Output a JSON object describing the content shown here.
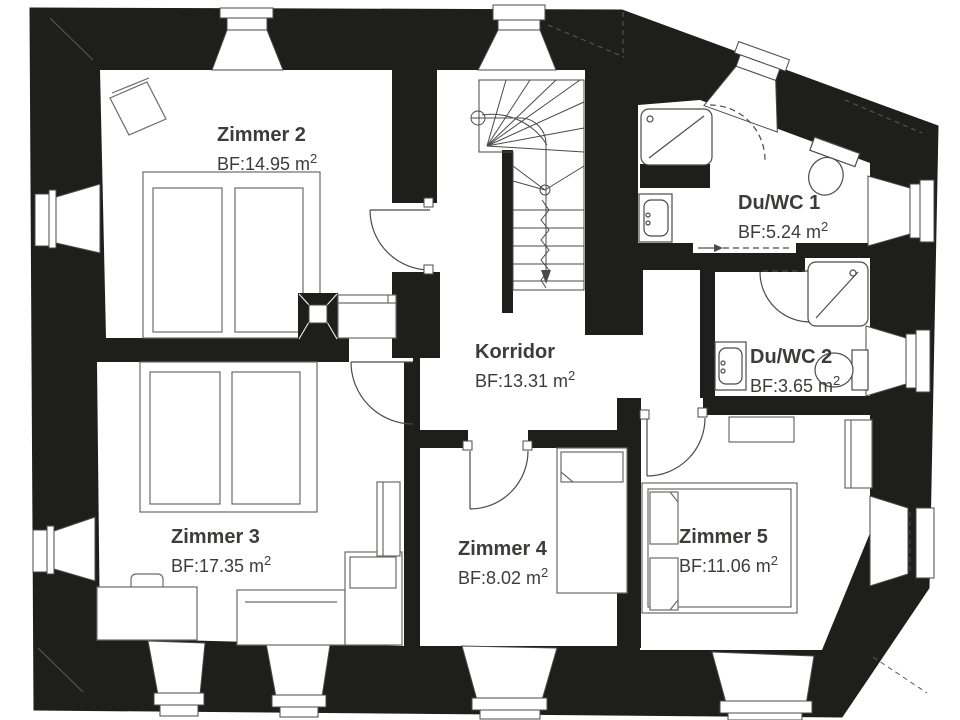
{
  "rooms": [
    {
      "name": "Zimmer 2",
      "bf": "BF:14.95 m",
      "sup": "2"
    },
    {
      "name": "Du/WC 1",
      "bf": "BF:5.24 m",
      "sup": "2"
    },
    {
      "name": "Korridor",
      "bf": "BF:13.31 m",
      "sup": "2"
    },
    {
      "name": "Du/WC 2",
      "bf": "BF:3.65 m",
      "sup": "2"
    },
    {
      "name": "Zimmer 3",
      "bf": "BF:17.35 m",
      "sup": "2"
    },
    {
      "name": "Zimmer 4",
      "bf": "BF:8.02 m",
      "sup": "2"
    },
    {
      "name": "Zimmer 5",
      "bf": "BF:11.06 m",
      "sup": "2"
    }
  ],
  "colors": {
    "wall": "#1e1e1c",
    "floor": "#ffffff",
    "fixture_line": "#4a4a49",
    "furniture_line": "#6b6b69",
    "text": "#3c3c3b"
  }
}
